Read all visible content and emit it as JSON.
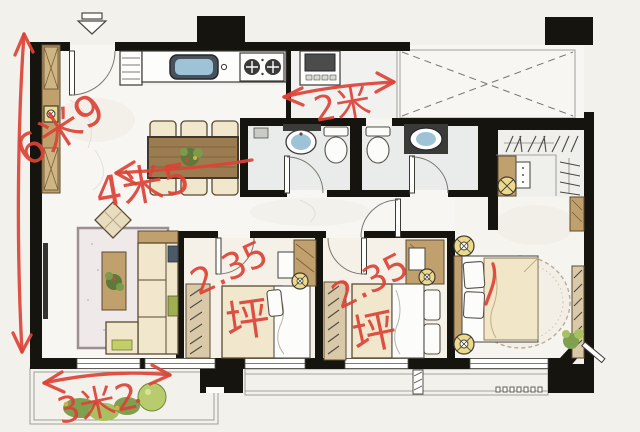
{
  "plan": {
    "annotations": {
      "height_total": "6米9",
      "living_width": "4米5",
      "laundry_width": "2米",
      "bedroom1": {
        "area": "2.35",
        "unit": "坪"
      },
      "bedroom2": {
        "area": "2.35",
        "unit": "坪"
      },
      "front_balcony_width": "3米2"
    },
    "colors": {
      "ink_red": "#dc4337",
      "wall_black": "#16140f",
      "wood": "#c0a06c",
      "paper": "#f3f1ec",
      "accent_yellow": "#ecd98b",
      "basin_blue": "#9fc3d6"
    }
  }
}
